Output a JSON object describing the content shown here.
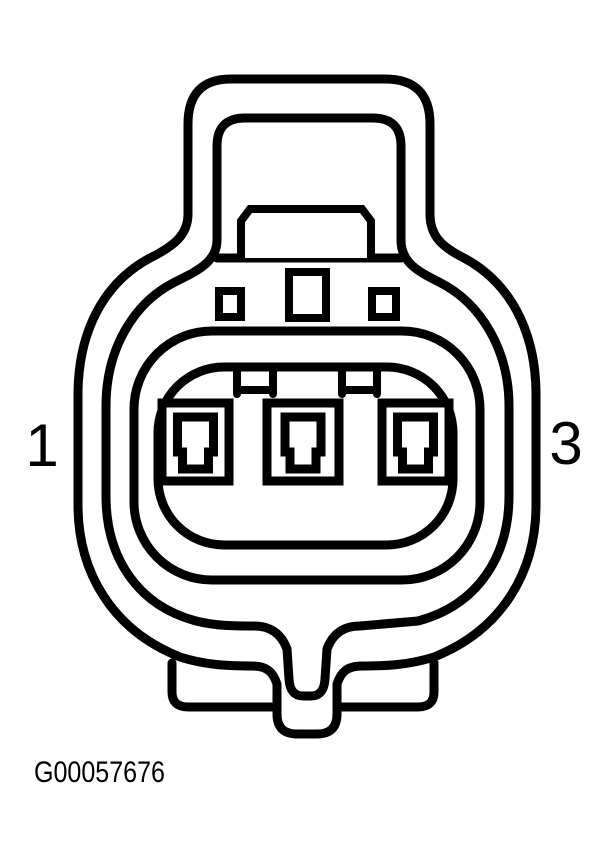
{
  "figure": {
    "caption": "G00057676",
    "pin_count": 3,
    "pin_labels": {
      "left": "1",
      "right": "3"
    },
    "colors": {
      "line": "#000000",
      "background": "#ffffff"
    }
  }
}
